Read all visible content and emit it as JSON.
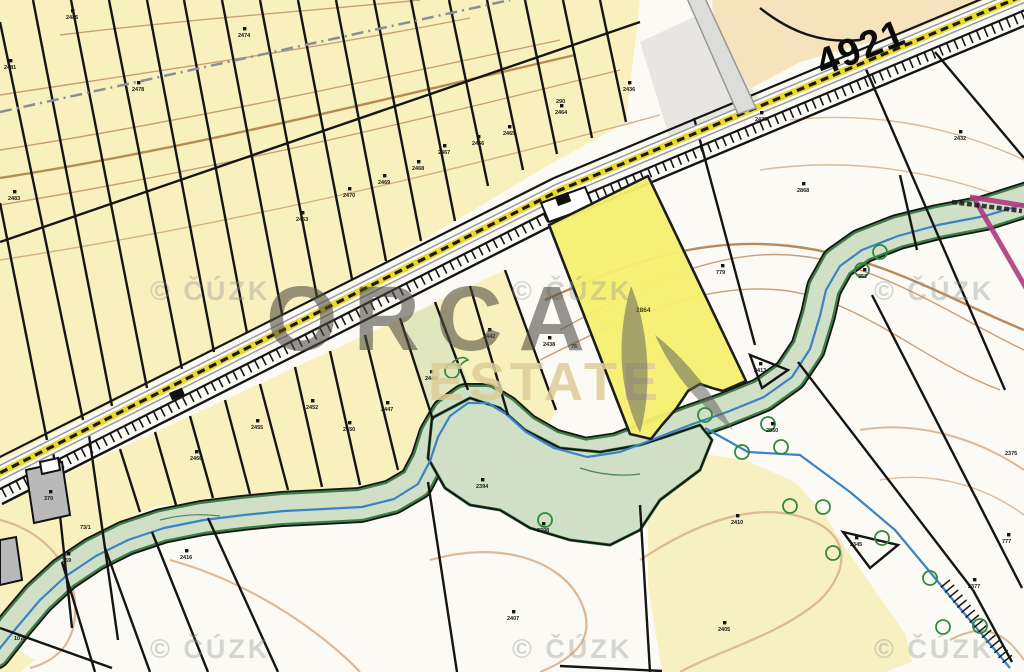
{
  "map": {
    "road_number": "4921",
    "highlighted_parcel_label": "2864",
    "watermark": {
      "copyright": "© ČÚZK",
      "logo_line1": "ORCA",
      "logo_line2": "ESTATE"
    },
    "colors": {
      "parcel_yellow": "#f9f1bd",
      "parcel_peach": "#f6e3bd",
      "highlight_yellow": "#f7ef70",
      "corridor_green": "#cfe0c6",
      "corridor_edge_green": "#3f7d49",
      "stream_blue": "#3c82c4",
      "contour_brown": "#c79b6e",
      "road_yellow": "#ead72e",
      "boundary_black": "#151515",
      "admin_magenta": "#b03a80",
      "building_gray": "#b9b9b9"
    },
    "parcel_labels": [
      {
        "t": "2481",
        "x": 4,
        "y": 69,
        "sq": 1
      },
      {
        "t": "2483",
        "x": 8,
        "y": 200,
        "sq": 1
      },
      {
        "t": "2478",
        "x": 132,
        "y": 91,
        "sq": 1
      },
      {
        "t": "2485",
        "x": 66,
        "y": 19,
        "sq": 1
      },
      {
        "t": "2474",
        "x": 238,
        "y": 37,
        "sq": 1
      },
      {
        "t": "2463",
        "x": 296,
        "y": 221,
        "sq": 1
      },
      {
        "t": "2470",
        "x": 343,
        "y": 197,
        "sq": 1
      },
      {
        "t": "2469",
        "x": 378,
        "y": 184,
        "sq": 1
      },
      {
        "t": "2468",
        "x": 412,
        "y": 170,
        "sq": 1
      },
      {
        "t": "2467",
        "x": 438,
        "y": 154,
        "sq": 1
      },
      {
        "t": "2466",
        "x": 472,
        "y": 145,
        "sq": 1
      },
      {
        "t": "2465",
        "x": 503,
        "y": 135,
        "sq": 1
      },
      {
        "t": "2464",
        "x": 555,
        "y": 114,
        "sq": 1
      },
      {
        "t": "2436",
        "x": 623,
        "y": 91,
        "sq": 1
      },
      {
        "t": "290",
        "x": 556,
        "y": 103,
        "sq": 0
      },
      {
        "t": "2460",
        "x": 190,
        "y": 460,
        "sq": 1
      },
      {
        "t": "2455",
        "x": 251,
        "y": 429,
        "sq": 1
      },
      {
        "t": "2452",
        "x": 306,
        "y": 409,
        "sq": 1
      },
      {
        "t": "2450",
        "x": 343,
        "y": 431,
        "sq": 1
      },
      {
        "t": "2447",
        "x": 381,
        "y": 411,
        "sq": 1
      },
      {
        "t": "2444",
        "x": 425,
        "y": 380,
        "sq": 1
      },
      {
        "t": "2442",
        "x": 483,
        "y": 338,
        "sq": 1
      },
      {
        "t": "2438",
        "x": 543,
        "y": 346,
        "sq": 1
      },
      {
        "t": "76",
        "x": 571,
        "y": 348,
        "sq": 0
      },
      {
        "t": "779",
        "x": 716,
        "y": 274,
        "sq": 1
      },
      {
        "t": "2432",
        "x": 954,
        "y": 140,
        "sq": 1
      },
      {
        "t": "2430",
        "x": 755,
        "y": 121,
        "sq": 1
      },
      {
        "t": "2868",
        "x": 797,
        "y": 192,
        "sq": 1
      },
      {
        "t": "352",
        "x": 858,
        "y": 278,
        "sq": 1
      },
      {
        "t": "2850",
        "x": 766,
        "y": 432,
        "sq": 1
      },
      {
        "t": "2413",
        "x": 754,
        "y": 372,
        "sq": 1
      },
      {
        "t": "2410",
        "x": 731,
        "y": 524,
        "sq": 1
      },
      {
        "t": "2405",
        "x": 718,
        "y": 631,
        "sq": 1
      },
      {
        "t": "2407",
        "x": 507,
        "y": 620,
        "sq": 1
      },
      {
        "t": "2377",
        "x": 968,
        "y": 588,
        "sq": 1
      },
      {
        "t": "777",
        "x": 1002,
        "y": 543,
        "sq": 1
      },
      {
        "t": "2375",
        "x": 1005,
        "y": 455,
        "sq": 0
      },
      {
        "t": "73/1",
        "x": 80,
        "y": 529,
        "sq": 0
      },
      {
        "t": "1079",
        "x": 14,
        "y": 640,
        "sq": 0
      },
      {
        "t": "370",
        "x": 44,
        "y": 500,
        "sq": 1
      },
      {
        "t": "369",
        "x": 62,
        "y": 562,
        "sq": 1
      },
      {
        "t": "2398",
        "x": 537,
        "y": 532,
        "sq": 1
      },
      {
        "t": "2394",
        "x": 476,
        "y": 488,
        "sq": 1
      },
      {
        "t": "2416",
        "x": 180,
        "y": 559,
        "sq": 1
      },
      {
        "t": "2345",
        "x": 850,
        "y": 546,
        "sq": 1
      }
    ]
  }
}
